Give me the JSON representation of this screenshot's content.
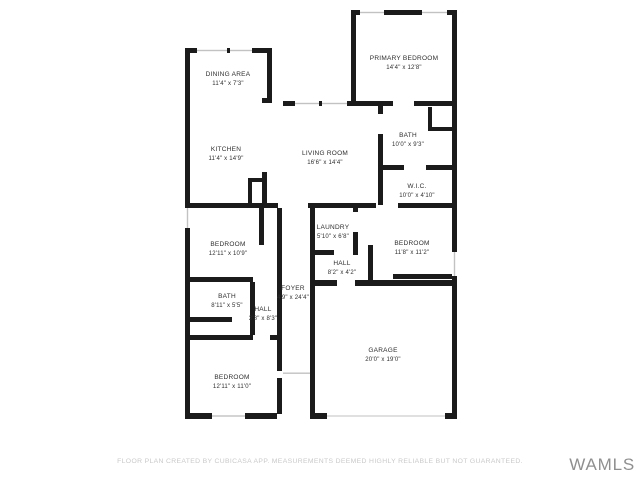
{
  "plan": {
    "rooms": [
      {
        "name": "DINING AREA",
        "dims": "11'4\" x 7'3\"",
        "x": 228,
        "y": 79
      },
      {
        "name": "PRIMARY BEDROOM",
        "dims": "14'4\" x 12'8\"",
        "x": 404,
        "y": 63
      },
      {
        "name": "KITCHEN",
        "dims": "11'4\" x 14'9\"",
        "x": 226,
        "y": 154
      },
      {
        "name": "LIVING ROOM",
        "dims": "16'6\" x 14'4\"",
        "x": 325,
        "y": 158
      },
      {
        "name": "BATH",
        "dims": "10'0\" x 9'3\"",
        "x": 408,
        "y": 140
      },
      {
        "name": "W.I.C.",
        "dims": "10'0\" x 4'10\"",
        "x": 417,
        "y": 191
      },
      {
        "name": "LAUNDRY",
        "dims": "5'10\" x 6'8\"",
        "x": 333,
        "y": 232
      },
      {
        "name": "BEDROOM",
        "dims": "11'8\" x 11'2\"",
        "x": 412,
        "y": 248
      },
      {
        "name": "BEDROOM",
        "dims": "12'11\" x 10'9\"",
        "x": 228,
        "y": 249
      },
      {
        "name": "HALL",
        "dims": "8'2\" x 4'2\"",
        "x": 342,
        "y": 268
      },
      {
        "name": "BATH",
        "dims": "8'11\" x 5'5\"",
        "x": 227,
        "y": 301
      },
      {
        "name": "HALL",
        "dims": "3'8\" x 8'3\"",
        "x": 263,
        "y": 314
      },
      {
        "name": "FOYER",
        "dims": "4'9\" x 24'4\"",
        "x": 293,
        "y": 293
      },
      {
        "name": "BEDROOM",
        "dims": "12'11\" x 11'0\"",
        "x": 232,
        "y": 382
      },
      {
        "name": "GARAGE",
        "dims": "20'0\" x 19'0\"",
        "x": 383,
        "y": 355
      }
    ],
    "colors": {
      "wall": "#1b1b1b",
      "window": "#c2c2c2",
      "label": "#2e2e2e",
      "background": "#ffffff"
    }
  },
  "footer": {
    "disclaimer": "FLOOR PLAN CREATED BY CUBICASA APP. MEASUREMENTS DEEMED HIGHLY RELIABLE BUT NOT GUARANTEED."
  },
  "watermark": {
    "text": "WAMLS"
  }
}
